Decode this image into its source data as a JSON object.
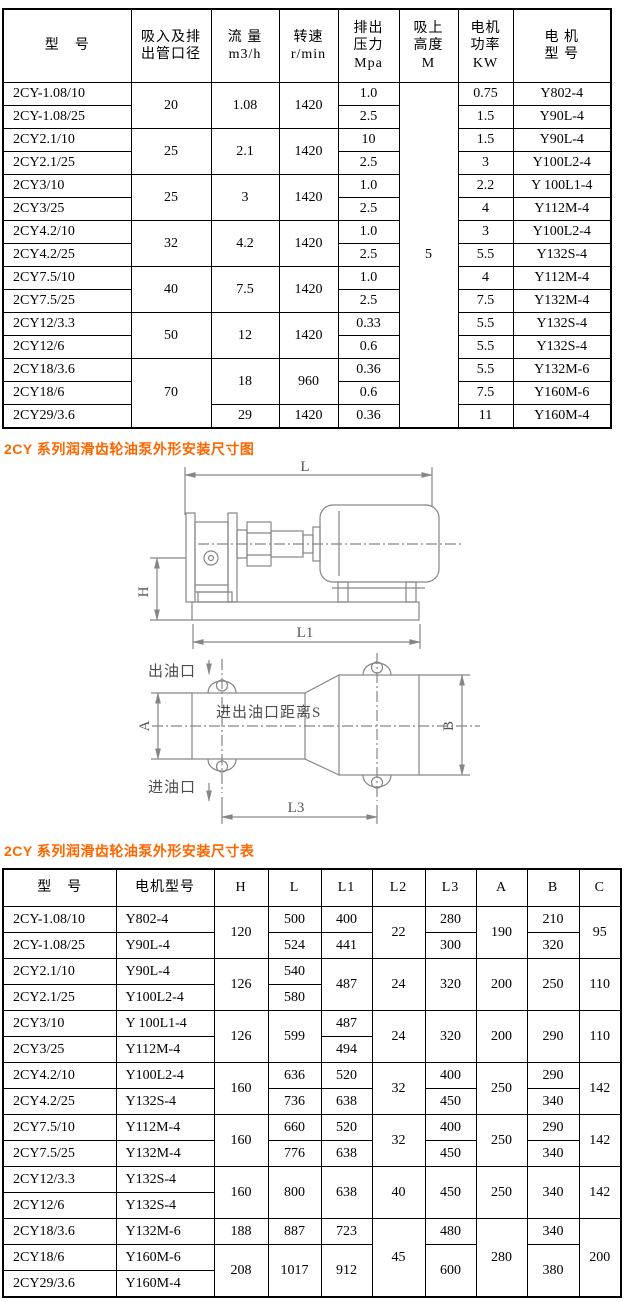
{
  "headings": {
    "diagram": "2CY 系列润滑齿轮油泵外形安装尺寸图",
    "dimensions": "2CY 系列润滑齿轮油泵外形安装尺寸表"
  },
  "spec_table": {
    "headers": [
      "型　号",
      "吸入及排\n出管口径",
      "流 量\nm3/h",
      "转速\nr/min",
      "排出\n压力\nMpa",
      "吸上\n高度\nM",
      "电机\n功率\nKW",
      "电 机\n型 号"
    ],
    "rows": [
      [
        {
          "t": "2CY-1.08/10"
        },
        {
          "t": "20",
          "rs": 2
        },
        {
          "t": "1.08",
          "rs": 2
        },
        {
          "t": "1420",
          "rs": 2
        },
        {
          "t": "1.0"
        },
        {
          "t": "5",
          "rs": 15
        },
        {
          "t": "0.75"
        },
        {
          "t": "Y802-4"
        }
      ],
      [
        {
          "t": "2CY-1.08/25"
        },
        {
          "t": "2.5"
        },
        {
          "t": "1.5"
        },
        {
          "t": "Y90L-4"
        }
      ],
      [
        {
          "t": "2CY2.1/10"
        },
        {
          "t": "25",
          "rs": 2
        },
        {
          "t": "2.1",
          "rs": 2
        },
        {
          "t": "1420",
          "rs": 2
        },
        {
          "t": "10"
        },
        {
          "t": "1.5"
        },
        {
          "t": "Y90L-4"
        }
      ],
      [
        {
          "t": "2CY2.1/25"
        },
        {
          "t": "2.5"
        },
        {
          "t": "3"
        },
        {
          "t": "Y100L2-4"
        }
      ],
      [
        {
          "t": "2CY3/10"
        },
        {
          "t": "25",
          "rs": 2
        },
        {
          "t": "3",
          "rs": 2
        },
        {
          "t": "1420",
          "rs": 2
        },
        {
          "t": "1.0"
        },
        {
          "t": "2.2"
        },
        {
          "t": "Y 100L1-4"
        }
      ],
      [
        {
          "t": "2CY3/25"
        },
        {
          "t": "2.5"
        },
        {
          "t": "4"
        },
        {
          "t": "Y112M-4"
        }
      ],
      [
        {
          "t": "2CY4.2/10"
        },
        {
          "t": "32",
          "rs": 2
        },
        {
          "t": "4.2",
          "rs": 2
        },
        {
          "t": "1420",
          "rs": 2
        },
        {
          "t": "1.0"
        },
        {
          "t": "3"
        },
        {
          "t": "Y100L2-4"
        }
      ],
      [
        {
          "t": "2CY4.2/25"
        },
        {
          "t": "2.5"
        },
        {
          "t": "5.5"
        },
        {
          "t": "Y132S-4"
        }
      ],
      [
        {
          "t": "2CY7.5/10"
        },
        {
          "t": "40",
          "rs": 2
        },
        {
          "t": "7.5",
          "rs": 2
        },
        {
          "t": "1420",
          "rs": 2
        },
        {
          "t": "1.0"
        },
        {
          "t": "4"
        },
        {
          "t": "Y112M-4"
        }
      ],
      [
        {
          "t": "2CY7.5/25"
        },
        {
          "t": "2.5"
        },
        {
          "t": "7.5"
        },
        {
          "t": "Y132M-4"
        }
      ],
      [
        {
          "t": "2CY12/3.3"
        },
        {
          "t": "50",
          "rs": 2
        },
        {
          "t": "12",
          "rs": 2
        },
        {
          "t": "1420",
          "rs": 2
        },
        {
          "t": "0.33"
        },
        {
          "t": "5.5"
        },
        {
          "t": "Y132S-4"
        }
      ],
      [
        {
          "t": "2CY12/6"
        },
        {
          "t": "0.6"
        },
        {
          "t": "5.5"
        },
        {
          "t": "Y132S-4"
        }
      ],
      [
        {
          "t": "2CY18/3.6"
        },
        {
          "t": "70",
          "rs": 3
        },
        {
          "t": "18",
          "rs": 2
        },
        {
          "t": "960",
          "rs": 2
        },
        {
          "t": "0.36"
        },
        {
          "t": "5.5"
        },
        {
          "t": "Y132M-6"
        }
      ],
      [
        {
          "t": "2CY18/6"
        },
        {
          "t": "0.6"
        },
        {
          "t": "7.5"
        },
        {
          "t": "Y160M-6"
        }
      ],
      [
        {
          "t": "2CY29/3.6"
        },
        {
          "t": "29"
        },
        {
          "t": "1420"
        },
        {
          "t": "0.36"
        },
        {
          "t": "11"
        },
        {
          "t": "Y160M-4"
        }
      ]
    ]
  },
  "dim_table": {
    "headers": [
      "型　号",
      "电机型号",
      "H",
      "L",
      "L1",
      "L2",
      "L3",
      "A",
      "B",
      "C"
    ],
    "rows": [
      [
        {
          "t": "2CY-1.08/10"
        },
        {
          "t": "Y802-4"
        },
        {
          "t": "120",
          "rs": 2
        },
        {
          "t": "500"
        },
        {
          "t": "400"
        },
        {
          "t": "22",
          "rs": 2
        },
        {
          "t": "280"
        },
        {
          "t": "190",
          "rs": 2
        },
        {
          "t": "210"
        },
        {
          "t": "95",
          "rs": 2
        }
      ],
      [
        {
          "t": "2CY-1.08/25"
        },
        {
          "t": "Y90L-4"
        },
        {
          "t": "524"
        },
        {
          "t": "441"
        },
        {
          "t": "300"
        },
        {
          "t": "320"
        }
      ],
      [
        {
          "t": "2CY2.1/10"
        },
        {
          "t": "Y90L-4"
        },
        {
          "t": "126",
          "rs": 2
        },
        {
          "t": "540"
        },
        {
          "t": "487",
          "rs": 2
        },
        {
          "t": "24",
          "rs": 2
        },
        {
          "t": "320",
          "rs": 2
        },
        {
          "t": "200",
          "rs": 2
        },
        {
          "t": "250",
          "rs": 2
        },
        {
          "t": "110",
          "rs": 2
        }
      ],
      [
        {
          "t": "2CY2.1/25"
        },
        {
          "t": "Y100L2-4"
        },
        {
          "t": "580"
        }
      ],
      [
        {
          "t": "2CY3/10"
        },
        {
          "t": "Y 100L1-4"
        },
        {
          "t": "126",
          "rs": 2
        },
        {
          "t": "599",
          "rs": 2
        },
        {
          "t": "487"
        },
        {
          "t": "24",
          "rs": 2
        },
        {
          "t": "320",
          "rs": 2
        },
        {
          "t": "200",
          "rs": 2
        },
        {
          "t": "290",
          "rs": 2
        },
        {
          "t": "110",
          "rs": 2
        }
      ],
      [
        {
          "t": "2CY3/25"
        },
        {
          "t": "Y112M-4"
        },
        {
          "t": "494"
        }
      ],
      [
        {
          "t": "2CY4.2/10"
        },
        {
          "t": "Y100L2-4"
        },
        {
          "t": "160",
          "rs": 2
        },
        {
          "t": "636"
        },
        {
          "t": "520"
        },
        {
          "t": "32",
          "rs": 2
        },
        {
          "t": "400"
        },
        {
          "t": "250",
          "rs": 2
        },
        {
          "t": "290"
        },
        {
          "t": "142",
          "rs": 2
        }
      ],
      [
        {
          "t": "2CY4.2/25"
        },
        {
          "t": "Y132S-4"
        },
        {
          "t": "736"
        },
        {
          "t": "638"
        },
        {
          "t": "450"
        },
        {
          "t": "340"
        }
      ],
      [
        {
          "t": "2CY7.5/10"
        },
        {
          "t": "Y112M-4"
        },
        {
          "t": "160",
          "rs": 2
        },
        {
          "t": "660"
        },
        {
          "t": "520"
        },
        {
          "t": "32",
          "rs": 2
        },
        {
          "t": "400"
        },
        {
          "t": "250",
          "rs": 2
        },
        {
          "t": "290"
        },
        {
          "t": "142",
          "rs": 2
        }
      ],
      [
        {
          "t": "2CY7.5/25"
        },
        {
          "t": "Y132M-4"
        },
        {
          "t": "776"
        },
        {
          "t": "638"
        },
        {
          "t": "450"
        },
        {
          "t": "340"
        }
      ],
      [
        {
          "t": "2CY12/3.3"
        },
        {
          "t": "Y132S-4"
        },
        {
          "t": "160",
          "rs": 2
        },
        {
          "t": "800",
          "rs": 2
        },
        {
          "t": "638",
          "rs": 2
        },
        {
          "t": "40",
          "rs": 2
        },
        {
          "t": "450",
          "rs": 2
        },
        {
          "t": "250",
          "rs": 2
        },
        {
          "t": "340",
          "rs": 2
        },
        {
          "t": "142",
          "rs": 2
        }
      ],
      [
        {
          "t": "2CY12/6"
        },
        {
          "t": "Y132S-4"
        }
      ],
      [
        {
          "t": "2CY18/3.6"
        },
        {
          "t": "Y132M-6"
        },
        {
          "t": "188"
        },
        {
          "t": "887"
        },
        {
          "t": "723"
        },
        {
          "t": "45",
          "rs": 3
        },
        {
          "t": "480"
        },
        {
          "t": "280",
          "rs": 3
        },
        {
          "t": "340"
        },
        {
          "t": "200",
          "rs": 3
        }
      ],
      [
        {
          "t": "2CY18/6"
        },
        {
          "t": "Y160M-6"
        },
        {
          "t": "208",
          "rs": 2
        },
        {
          "t": "1017",
          "rs": 2
        },
        {
          "t": "912",
          "rs": 2
        },
        {
          "t": "600",
          "rs": 2
        },
        {
          "t": "380",
          "rs": 2
        }
      ],
      [
        {
          "t": "2CY29/3.6"
        },
        {
          "t": "Y160M-4"
        }
      ]
    ]
  },
  "diagram": {
    "labels": {
      "L": "L",
      "H": "H",
      "L1": "L1",
      "outlet": "出油口",
      "port_distance": "进出油口距离S",
      "inlet": "进油口",
      "A": "A",
      "B": "B",
      "L3": "L3"
    }
  },
  "colors": {
    "heading": "#FF6600",
    "table_border": "#000000",
    "diagram_line": "#868686"
  }
}
